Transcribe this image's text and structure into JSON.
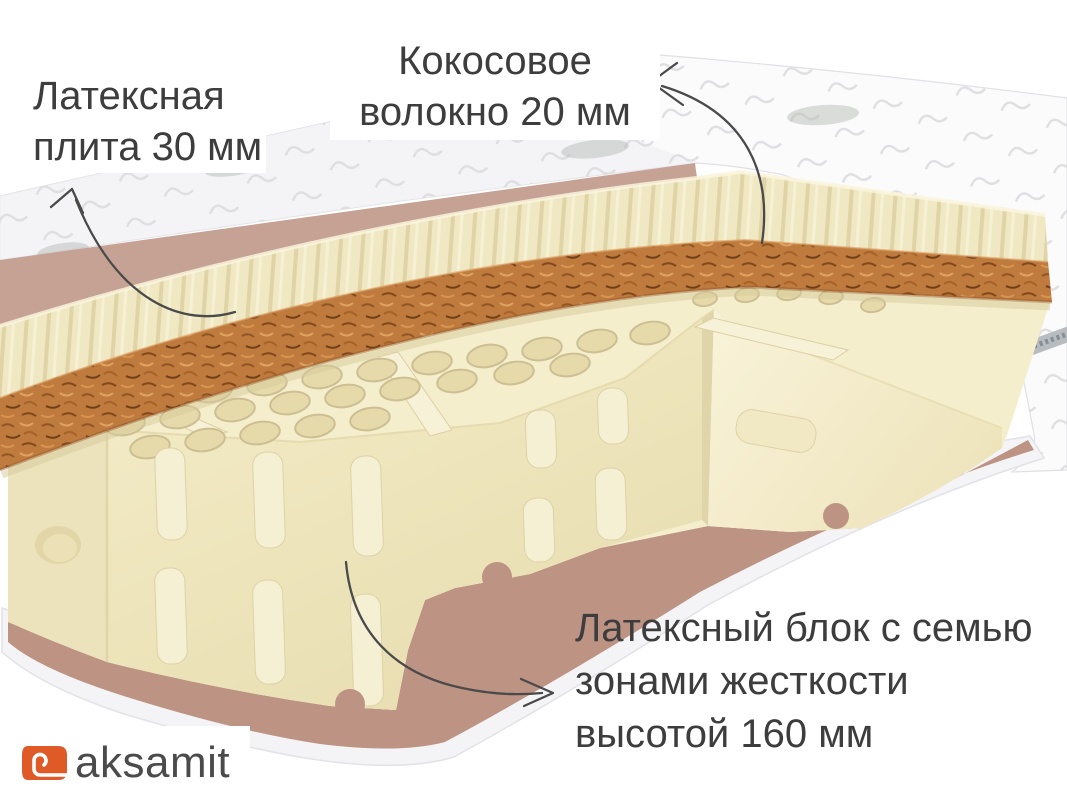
{
  "labels": {
    "latex_plate": {
      "line1": "Латексная",
      "line2": "плита 30 мм"
    },
    "coconut_fiber": {
      "line1": "Кокосовое",
      "line2": "волокно 20 мм"
    },
    "latex_block": {
      "line1": "Латексный блок с семью",
      "line2": "зонами жесткости",
      "line3": "высотой 160 мм"
    }
  },
  "logo": {
    "text": "aksamit"
  },
  "colors": {
    "background": "#ffffff",
    "label_text": "#3d3d3d",
    "arrow": "#4a4a4a",
    "cover_white": "#fbfbfc",
    "cover_quilt_stitch": "#dcdcdf",
    "cover_underside_rose": "#c6a295",
    "latex_cream": "#f2eac6",
    "coconut_brown": "#bf7a3e",
    "base_rose": "#bd9384",
    "logo_orange": "#e05a28",
    "logo_text": "#4b4b4b"
  },
  "parts": [
    {
      "name": "quilted-cover"
    },
    {
      "name": "latex-plate-30mm"
    },
    {
      "name": "coconut-fiber-20mm"
    },
    {
      "name": "latex-block-160mm-seven-zones"
    },
    {
      "name": "bottom-cover-base"
    }
  ]
}
